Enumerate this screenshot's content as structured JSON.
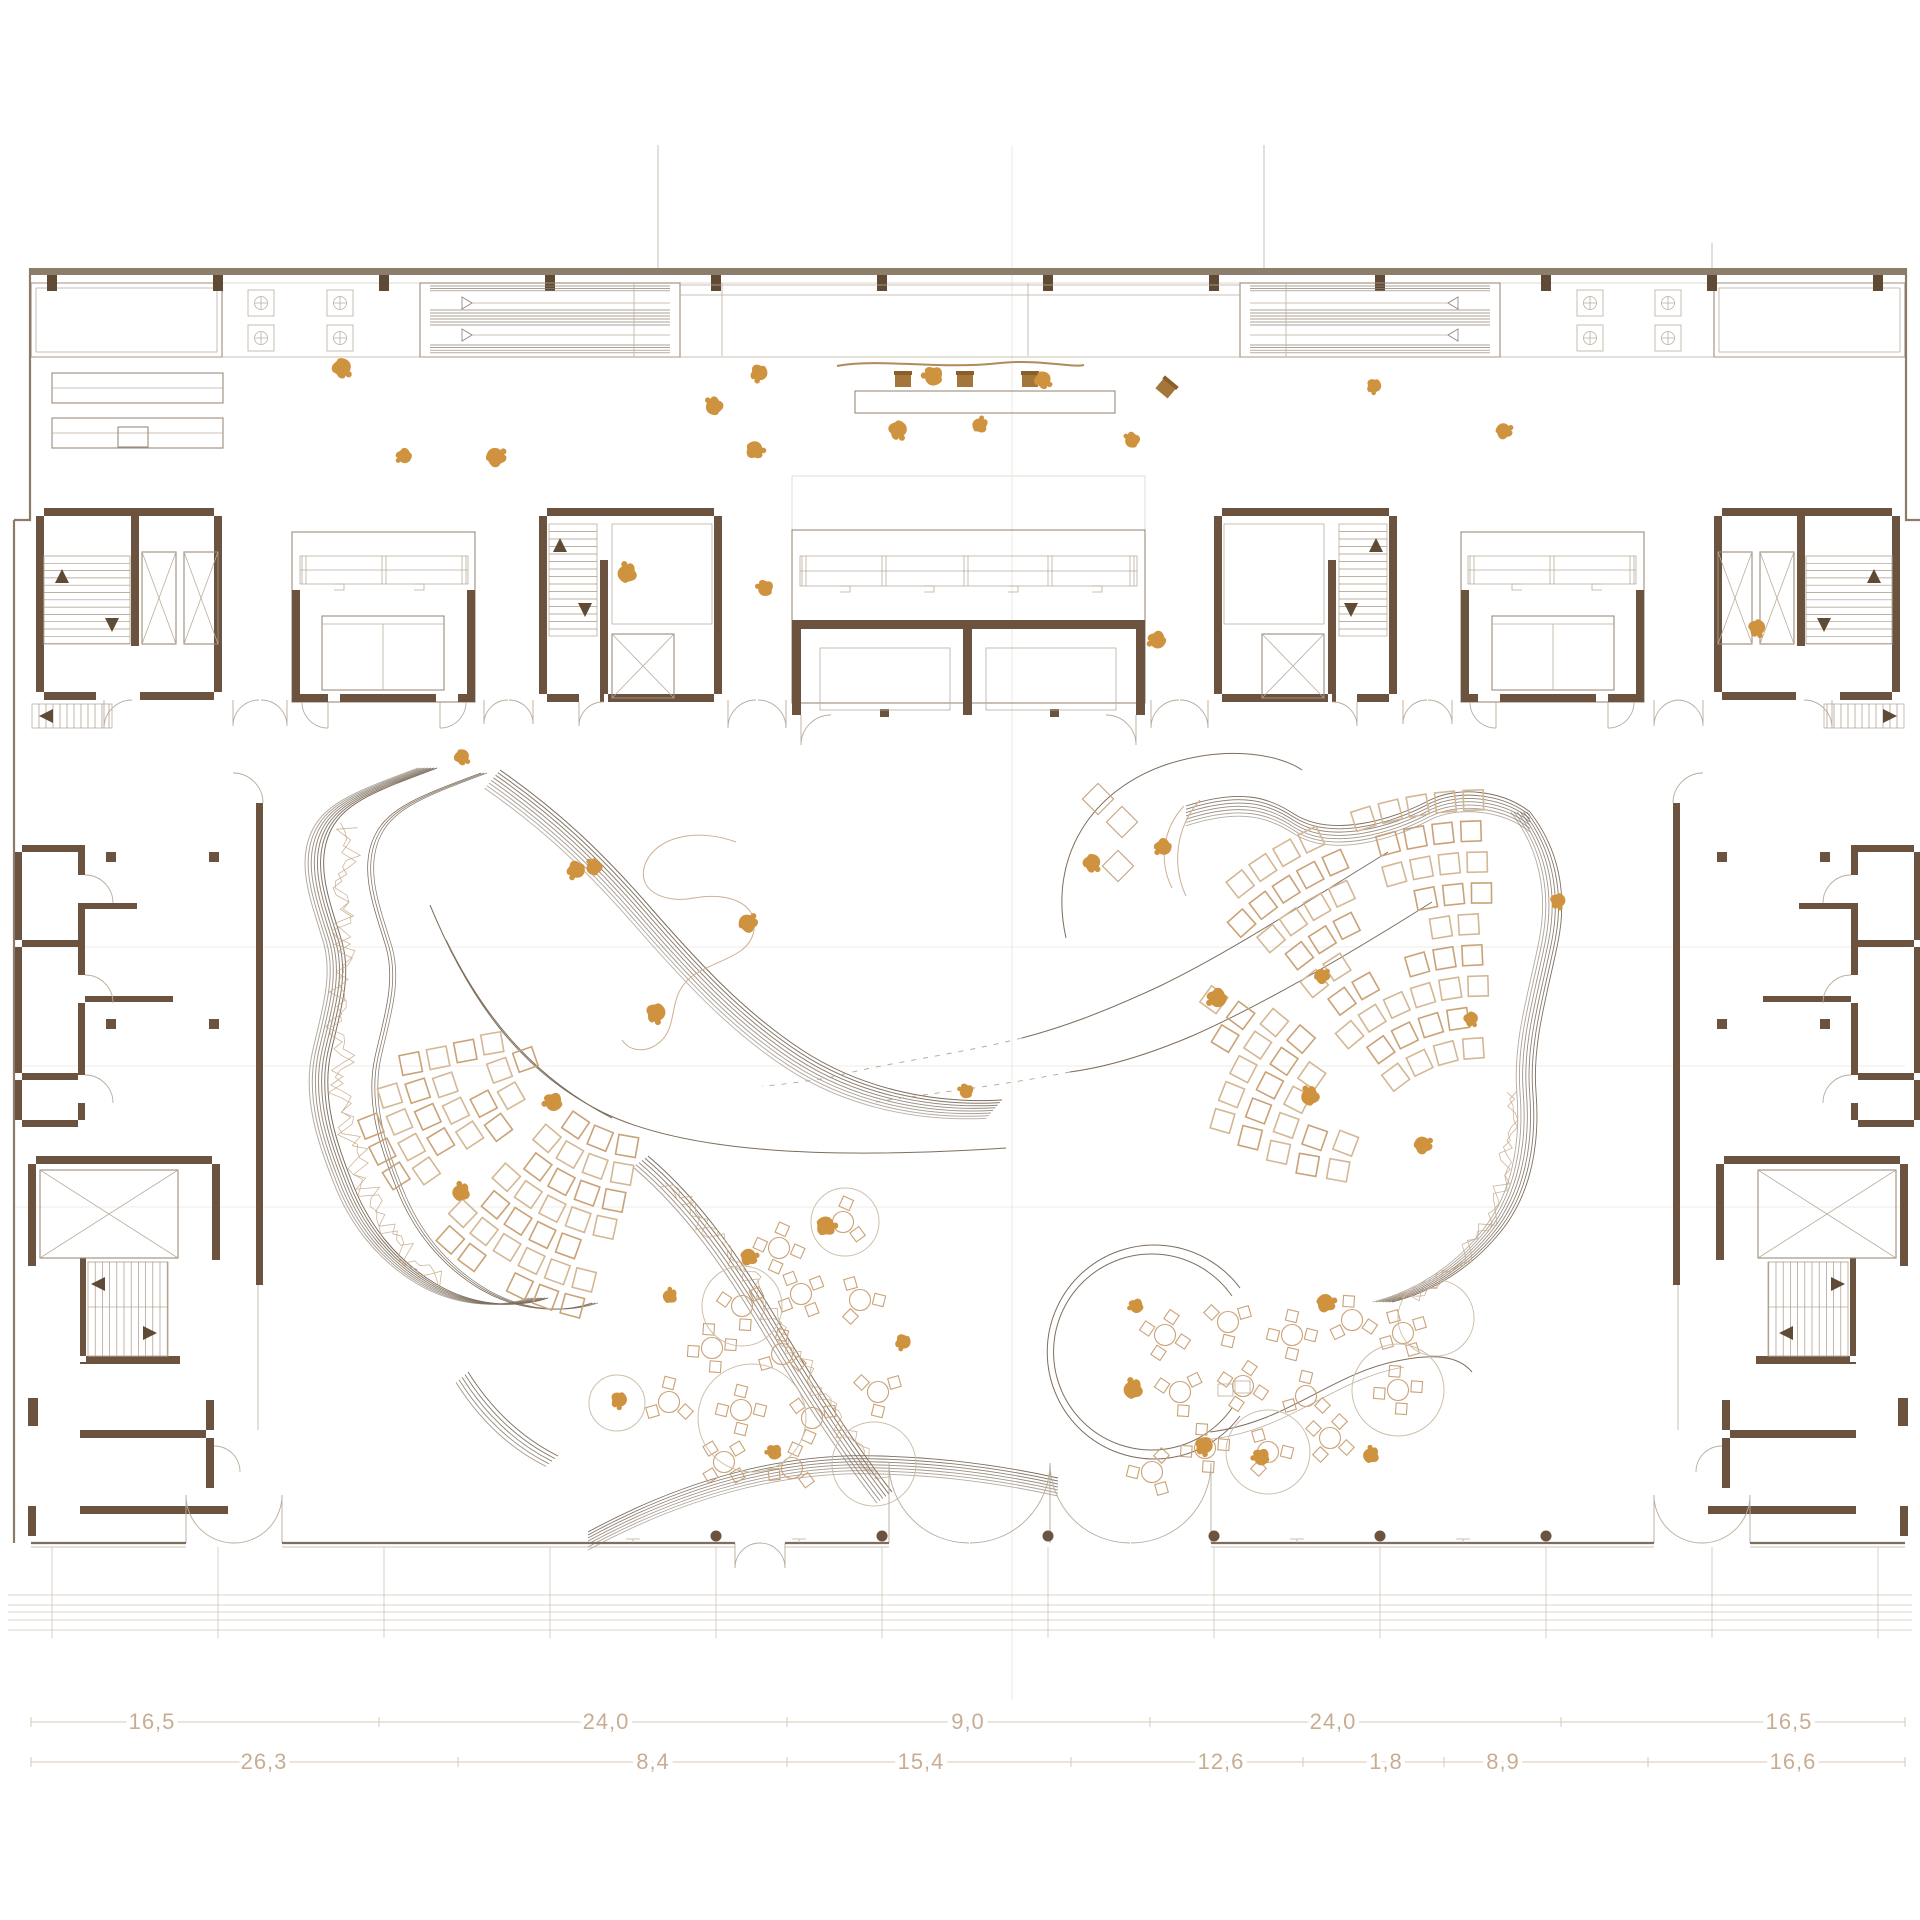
{
  "drawing": {
    "type": "architectural-floor-plan",
    "units_note": "dimension chain values as printed",
    "colors": {
      "wall_brown": "#6b5340",
      "people_orange": "#cf923f",
      "seat_tan": "#c9a277",
      "seat_tan_light": "#d4b794",
      "ridge_dark": "#7d6e5e",
      "scribble_tan": "#c6a887",
      "line_mid": "#9a8b7b",
      "line_light": "#bcae9d",
      "dim_text": "#c8ad93"
    }
  },
  "dimensions": {
    "row1": {
      "y": 1722,
      "ticks": [
        31,
        379,
        787,
        1150,
        1561,
        1905
      ],
      "labels": [
        {
          "t": "16,5",
          "x": 152
        },
        {
          "t": "24,0",
          "x": 606
        },
        {
          "t": "9,0",
          "x": 968
        },
        {
          "t": "24,0",
          "x": 1333
        },
        {
          "t": "16,5",
          "x": 1789
        }
      ]
    },
    "row2": {
      "y": 1762,
      "ticks": [
        31,
        458,
        787,
        1071,
        1303,
        1444,
        1648,
        1905
      ],
      "labels": [
        {
          "t": "26,3",
          "x": 264
        },
        {
          "t": "8,4",
          "x": 653
        },
        {
          "t": "15,4",
          "x": 921
        },
        {
          "t": "12,6",
          "x": 1221
        },
        {
          "t": "1,8",
          "x": 1386
        },
        {
          "t": "8,9",
          "x": 1503
        },
        {
          "t": "16,6",
          "x": 1793
        }
      ]
    }
  },
  "reference_lines": {
    "verticals_above_wall": [
      {
        "x": 658,
        "y1": 145,
        "y2": 268
      },
      {
        "x": 1264,
        "y1": 145,
        "y2": 268
      },
      {
        "x": 1712,
        "y1": 243,
        "y2": 268
      }
    ],
    "center_axis": {
      "x": 1012,
      "y1": 145,
      "y2": 1700
    },
    "hairlines_y": [
      947,
      1066,
      1207
    ]
  },
  "top_wall": {
    "x1": 31,
    "x2": 1905,
    "y": 268,
    "h": 7,
    "piers": [
      52,
      218,
      384,
      550,
      716,
      882,
      1048,
      1214,
      1380,
      1546,
      1712,
      1878
    ]
  },
  "phi_symbols": [
    [
      261,
      303
    ],
    [
      340,
      303
    ],
    [
      261,
      338
    ],
    [
      340,
      338
    ],
    [
      1590,
      303
    ],
    [
      1668,
      303
    ],
    [
      1590,
      338
    ],
    [
      1668,
      338
    ]
  ],
  "louver_blocks": [
    {
      "x": 420,
      "y": 283,
      "w": 260,
      "h": 74,
      "dir": -1
    },
    {
      "x": 1240,
      "y": 283,
      "w": 260,
      "h": 74,
      "dir": 1
    }
  ],
  "door_pairs": [
    [
      233,
      287,
      700,
      26,
      1
    ],
    [
      484,
      533,
      700,
      24,
      1
    ],
    [
      728,
      786,
      700,
      28,
      1
    ],
    [
      1151,
      1208,
      700,
      28,
      1
    ],
    [
      1403,
      1452,
      700,
      24,
      1
    ],
    [
      1654,
      1703,
      700,
      26,
      1
    ],
    [
      889,
      1050,
      1543,
      80,
      -1
    ],
    [
      1050,
      1211,
      1543,
      80,
      -1
    ],
    [
      186,
      282,
      1543,
      48,
      -1
    ],
    [
      1654,
      1750,
      1543,
      48,
      -1
    ],
    [
      735,
      785,
      1543,
      25,
      1
    ]
  ],
  "facade": {
    "y": 1543,
    "columns": [
      716,
      882,
      1048,
      1214,
      1380,
      1546
    ],
    "ticks": [
      633,
      799,
      1297,
      1463
    ],
    "terrace_lines_y": [
      1595,
      1605,
      1612,
      1620,
      1630
    ],
    "terrace_verticals": [
      52,
      218,
      384,
      550,
      716,
      882,
      1048,
      1214,
      1380,
      1546,
      1712,
      1878
    ]
  },
  "ridge_bands": [
    {
      "d": "M437,768 C378,790 345,802 331,830 C314,864 330,902 342,942 C352,977 340,1012 331,1052 C321,1097 336,1142 352,1182 C368,1224 396,1260 436,1284 C470,1304 512,1310 548,1298",
      "n": 7,
      "dx": -3.1,
      "dy": 0,
      "w": 1.0
    },
    {
      "d": "M437,768 C378,790 345,802 331,830 C314,864 330,902 342,942 C352,977 340,1012 331,1052 C321,1097 336,1142 352,1182 C368,1224 396,1260 436,1284 C470,1304 512,1310 548,1298",
      "t": "translate(44,5)",
      "n": 3,
      "dx": 3.0,
      "dy": 0,
      "w": 0.8
    },
    {
      "d": "M500,770 C560,812 602,852 650,907 C698,962 744,1012 802,1050 C860,1088 932,1104 1002,1100",
      "n": 8,
      "dx": -2.2,
      "dy": 2.6,
      "w": 1.0
    },
    {
      "d": "M1186,806 C1242,788 1270,798 1294,814 C1332,838 1392,820 1430,800 C1458,786 1502,790 1530,812",
      "n": 7,
      "dx": 0,
      "dy": 3.3,
      "w": 0.9
    },
    {
      "d": "M1530,812 C1558,848 1568,892 1558,942 C1548,992 1532,1042 1536,1092 C1540,1142 1532,1192 1502,1230 C1472,1268 1432,1292 1392,1302",
      "n": 7,
      "dx": -3.2,
      "dy": 0,
      "w": 0.9
    },
    {
      "d": "M648,1156 C700,1200 740,1258 776,1318 C812,1378 850,1438 892,1492",
      "n": 6,
      "dx": -3.0,
      "dy": 2.2,
      "w": 1.0
    },
    {
      "d": "M588,1532 C680,1482 780,1452 880,1456 C960,1458 1022,1470 1058,1478",
      "n": 7,
      "dx": 0,
      "dy": 3.0,
      "w": 0.9
    },
    {
      "d": "M468,1372 C492,1410 522,1438 558,1456",
      "n": 5,
      "dx": -3.0,
      "dy": 2.6,
      "w": 0.9
    }
  ],
  "scribbles": [
    {
      "d": "M352,826 C334,886 350,946 342,1006 C332,1066 346,1126 362,1178 C380,1228 408,1262 444,1286",
      "amp": 13
    },
    {
      "d": "M668,1180 C714,1228 752,1282 788,1340 C824,1398 858,1450 886,1488",
      "amp": 11
    },
    {
      "d": "M1512,1092 C1516,1148 1504,1200 1478,1240 C1452,1278 1418,1296 1394,1304",
      "amp": 10
    }
  ],
  "seating_fans": [
    {
      "cx": 650,
      "cy": 1016,
      "seat": 20,
      "gap": 8,
      "light": true,
      "rows": [
        [
          132,
          100,
          172
        ],
        [
          160,
          100,
          174
        ],
        [
          188,
          101,
          175
        ],
        [
          216,
          102,
          176
        ],
        [
          244,
          103,
          170
        ],
        [
          272,
          104,
          166
        ],
        [
          300,
          105,
          160
        ]
      ],
      "aisles": [
        [
          134,
          143
        ]
      ]
    },
    {
      "cx": 1484,
      "cy": 1196,
      "seat": 20,
      "gap": 8,
      "light": false,
      "rows": [
        [
          148,
          190,
          268
        ],
        [
          179,
          190,
          270
        ],
        [
          210,
          192,
          271
        ],
        [
          241,
          194,
          272
        ],
        [
          272,
          196,
          272
        ],
        [
          303,
          206,
          272
        ],
        [
          334,
          216,
          272
        ],
        [
          365,
          224,
          271
        ],
        [
          396,
          232,
          270
        ]
      ],
      "aisles": [
        [
          221,
          228
        ],
        [
          246,
          252
        ]
      ]
    }
  ],
  "cafe": {
    "cluster1": [
      [
        779,
        1248,
        4,
        10
      ],
      [
        843,
        1222,
        3,
        40
      ],
      [
        742,
        1306,
        3,
        200
      ],
      [
        801,
        1294,
        4,
        55
      ],
      [
        860,
        1300,
        3,
        0
      ],
      [
        712,
        1348,
        4,
        80
      ],
      [
        782,
        1354,
        3,
        150
      ],
      [
        669,
        1402,
        3,
        30
      ],
      [
        741,
        1410,
        4,
        0
      ],
      [
        812,
        1418,
        3,
        100
      ],
      [
        878,
        1392,
        3,
        210
      ],
      [
        724,
        1462,
        4,
        45
      ],
      [
        792,
        1468,
        3,
        160
      ]
    ],
    "circles1": [
      [
        845,
        1222,
        34
      ],
      [
        742,
        1306,
        40
      ],
      [
        752,
        1418,
        54
      ],
      [
        874,
        1464,
        42
      ],
      [
        617,
        1403,
        28
      ]
    ],
    "cluster2": [
      [
        1165,
        1335,
        4,
        20
      ],
      [
        1228,
        1322,
        3,
        90
      ],
      [
        1292,
        1335,
        4,
        0
      ],
      [
        1352,
        1320,
        3,
        140
      ],
      [
        1403,
        1333,
        4,
        60
      ],
      [
        1180,
        1392,
        3,
        200
      ],
      [
        1243,
        1386,
        4,
        110
      ],
      [
        1306,
        1396,
        3,
        30
      ],
      [
        1398,
        1390,
        4,
        170
      ],
      [
        1205,
        1448,
        4,
        80
      ],
      [
        1268,
        1452,
        3,
        0
      ],
      [
        1330,
        1438,
        4,
        120
      ],
      [
        1152,
        1472,
        3,
        60
      ]
    ],
    "circles2": [
      [
        1436,
        1318,
        38
      ],
      [
        1398,
        1390,
        46
      ],
      [
        1268,
        1452,
        42
      ]
    ]
  },
  "stage_diamonds": [
    [
      1122,
      822
    ],
    [
      1118,
      866
    ],
    [
      1098,
      799
    ]
  ],
  "info_desk": {
    "rect": [
      855,
      391,
      260,
      22
    ],
    "squiggle": "M837,366 C880,358 940,370 1000,363 C1040,359 1072,368 1084,365",
    "chairs": [
      [
        903,
        380,
        0
      ],
      [
        965,
        380,
        0
      ],
      [
        1030,
        380,
        0
      ],
      [
        1166,
        388,
        40
      ]
    ]
  },
  "reception_counters": [
    [
      52,
      373,
      171,
      30
    ],
    [
      52,
      418,
      171,
      30
    ]
  ],
  "people": [
    [
      342,
      368,
      20
    ],
    [
      404,
      456,
      120
    ],
    [
      496,
      457,
      300
    ],
    [
      759,
      373,
      80
    ],
    [
      714,
      406,
      200
    ],
    [
      755,
      450,
      340
    ],
    [
      898,
      430,
      40
    ],
    [
      933,
      376,
      160
    ],
    [
      980,
      425,
      260
    ],
    [
      1043,
      380,
      10
    ],
    [
      1132,
      440,
      190
    ],
    [
      1374,
      386,
      70
    ],
    [
      1504,
      431,
      310
    ],
    [
      1157,
      640,
      130
    ],
    [
      627,
      573,
      230
    ],
    [
      1757,
      628,
      45
    ],
    [
      765,
      588,
      170
    ],
    [
      462,
      757,
      15
    ],
    [
      576,
      870,
      95
    ],
    [
      594,
      867,
      205
    ],
    [
      748,
      923,
      285
    ],
    [
      656,
      1013,
      55
    ],
    [
      553,
      1102,
      145
    ],
    [
      461,
      1192,
      235
    ],
    [
      749,
      1257,
      325
    ],
    [
      619,
      1400,
      65
    ],
    [
      774,
      1452,
      155
    ],
    [
      670,
      1296,
      245
    ],
    [
      826,
      1226,
      335
    ],
    [
      903,
      1342,
      85
    ],
    [
      966,
      1091,
      175
    ],
    [
      1092,
      863,
      25
    ],
    [
      1163,
      847,
      115
    ],
    [
      1322,
      976,
      295
    ],
    [
      1471,
      1019,
      35
    ],
    [
      1217,
      998,
      125
    ],
    [
      1310,
      1096,
      215
    ],
    [
      1423,
      1145,
      305
    ],
    [
      1558,
      901,
      50
    ],
    [
      1136,
      1306,
      140
    ],
    [
      1133,
      1389,
      230
    ],
    [
      1326,
      1303,
      320
    ],
    [
      1204,
      1446,
      60
    ],
    [
      1261,
      1457,
      150
    ],
    [
      1371,
      1455,
      240
    ]
  ],
  "fixtures": {
    "stairs": [
      {
        "parent": "leftCores",
        "x": 44,
        "y": 556,
        "w": 86,
        "h": 88,
        "o": "h",
        "step": 7.3
      },
      {
        "parent": "leftCores",
        "x": 32,
        "y": 704,
        "w": 80,
        "h": 24,
        "o": "v",
        "step": 7.0
      },
      {
        "parent": "leftCores",
        "x": 549,
        "y": 524,
        "w": 48,
        "h": 112,
        "o": "h",
        "step": 7.5
      },
      {
        "parent": "wingL",
        "x": 88,
        "y": 1262,
        "w": 80,
        "h": 94,
        "o": "v",
        "step": 7.2
      }
    ],
    "arrows": [
      {
        "parent": "leftCores",
        "x": 62,
        "y": 576,
        "dir": "up"
      },
      {
        "parent": "leftCores",
        "x": 112,
        "y": 625,
        "dir": "down"
      },
      {
        "parent": "leftCores",
        "x": 46,
        "y": 716,
        "dir": "left"
      },
      {
        "parent": "leftCores",
        "x": 560,
        "y": 545,
        "dir": "up"
      },
      {
        "parent": "leftCores",
        "x": 585,
        "y": 610,
        "dir": "down"
      },
      {
        "parent": "wingL",
        "x": 98,
        "y": 1284,
        "dir": "left"
      },
      {
        "parent": "wingL",
        "x": 150,
        "y": 1333,
        "dir": "right"
      }
    ],
    "elevators": [
      {
        "parent": "leftCores",
        "x": 142,
        "y": 552,
        "w": 34,
        "h": 92
      },
      {
        "parent": "leftCores",
        "x": 184,
        "y": 552,
        "w": 34,
        "h": 92
      },
      {
        "parent": "leftCores",
        "x": 612,
        "y": 634,
        "w": 62,
        "h": 64
      },
      {
        "parent": "wingL",
        "x": 40,
        "y": 1170,
        "w": 138,
        "h": 88
      }
    ]
  }
}
